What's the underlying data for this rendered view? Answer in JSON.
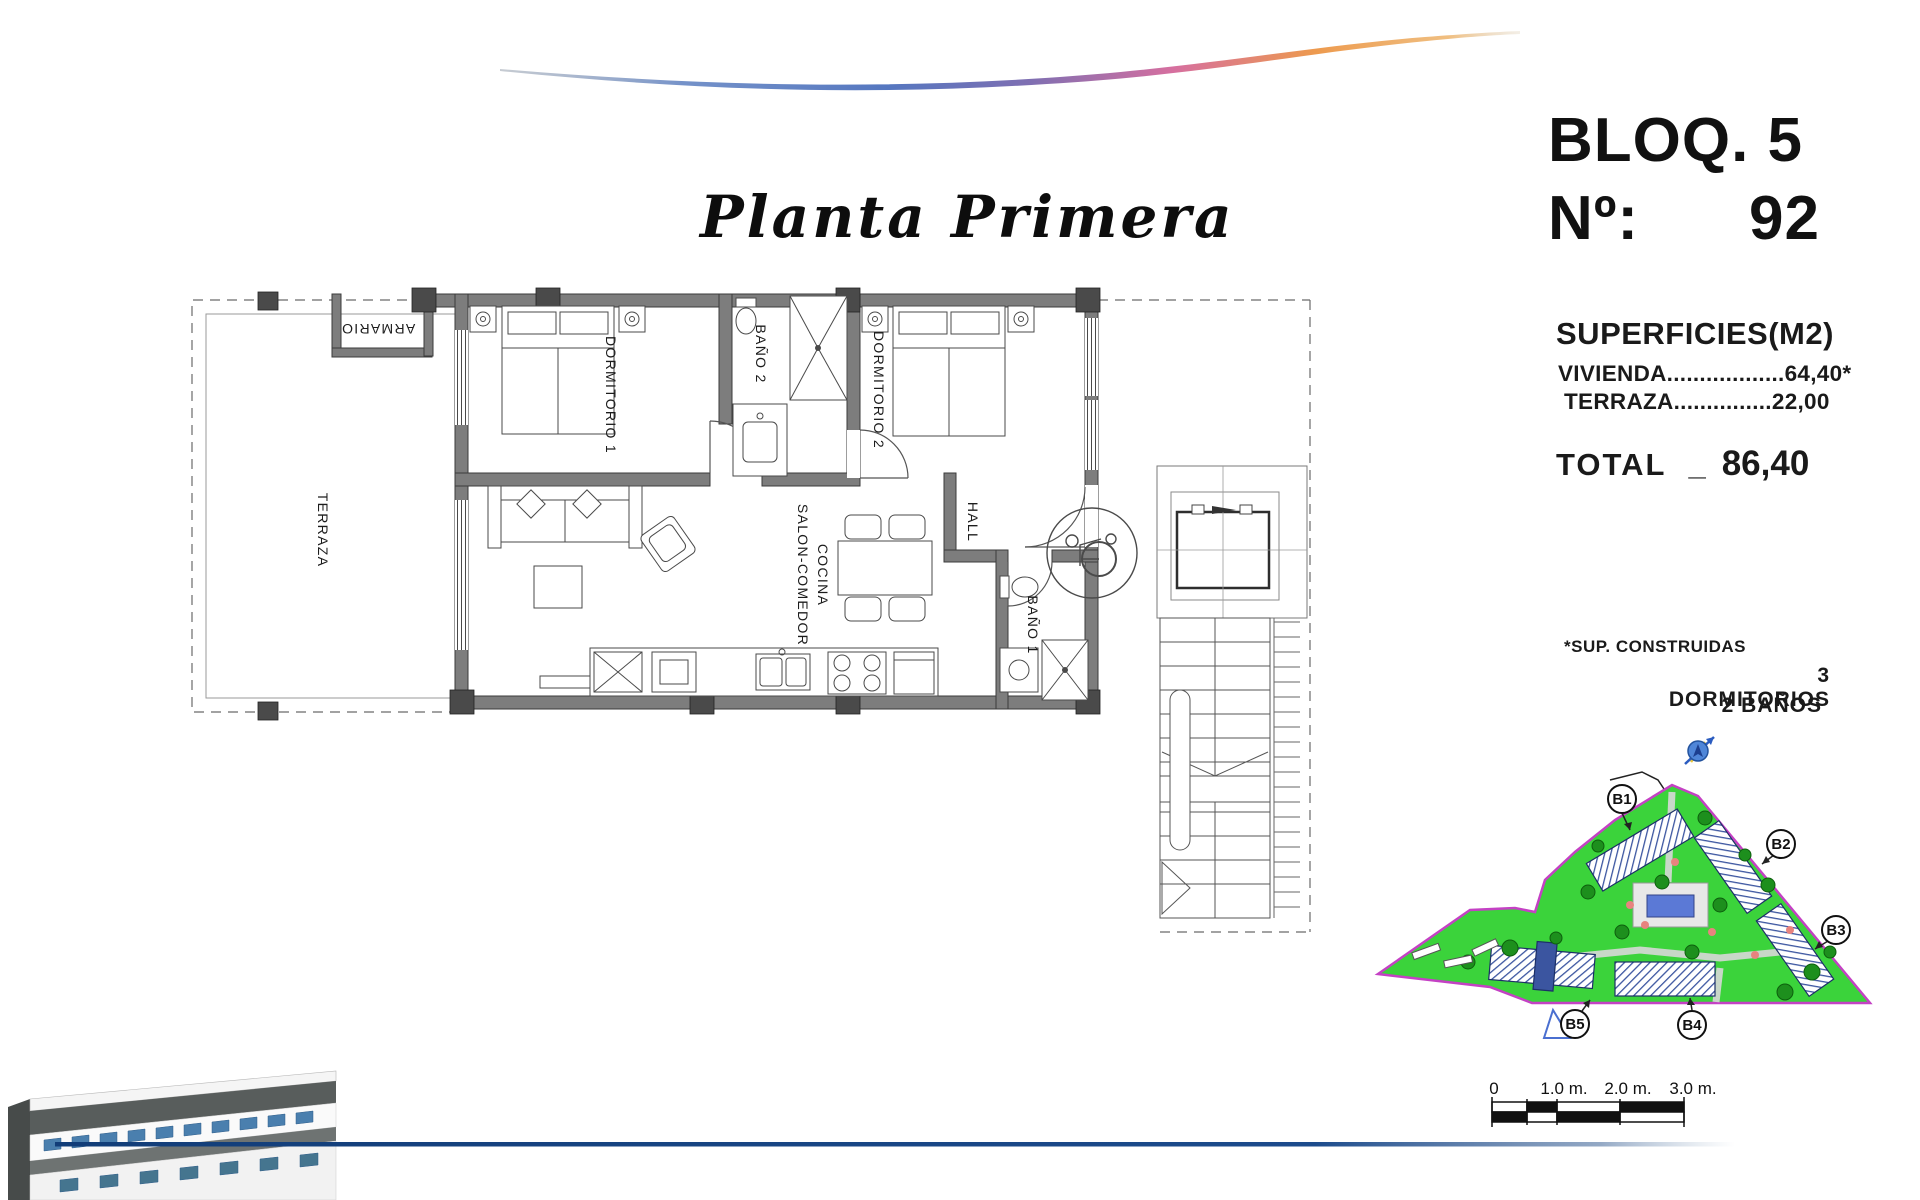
{
  "header": {
    "title": "Planta Primera"
  },
  "unit": {
    "block_label": "BLOQ. 5",
    "number_label": "Nº:",
    "number": "92"
  },
  "surfaces": {
    "heading": "SUPERFICIES(M2)",
    "rows": [
      {
        "label": "VIVIENDA",
        "dots": "..................",
        "value": "64,40*"
      },
      {
        "label": "TERRAZA",
        "dots": "...............",
        "value": "22,00"
      }
    ],
    "total_label": "TOTAL",
    "total_separator": "_",
    "total_value": "86,40"
  },
  "notes": {
    "built_surface": "*SUP. CONSTRUIDAS",
    "bedrooms": "3 DORMITORIOS",
    "bathrooms": "2 BAÑOS"
  },
  "floorplan": {
    "rooms": {
      "terraza": "TERRAZA",
      "armario": "ARMARIO",
      "dormitorio1": "DORMITORIO 1",
      "bano2": "BAÑO 2",
      "dormitorio2": "DORMITORIO 2",
      "hall": "HALL",
      "salon_line1": "SALON-COMEDOR",
      "salon_line2": "COCINA",
      "bano1": "BAÑO 1"
    }
  },
  "siteplan": {
    "blocks": [
      "B1",
      "B2",
      "B3",
      "B4",
      "B5"
    ]
  },
  "scalebar": {
    "labels": [
      "0",
      "1.0 m.",
      "2.0 m.",
      "3.0 m."
    ]
  },
  "colors": {
    "wall_gray": "#7d7d7d",
    "site_green": "#3bd33b",
    "site_boundary": "#c441c4",
    "pool_blue": "#5b79d6",
    "hatch_navy": "#3b55a0",
    "bottom_line_blue": "#16437f",
    "swoosh_blue": "#5577c0",
    "swoosh_orange": "#ed9a4e"
  }
}
